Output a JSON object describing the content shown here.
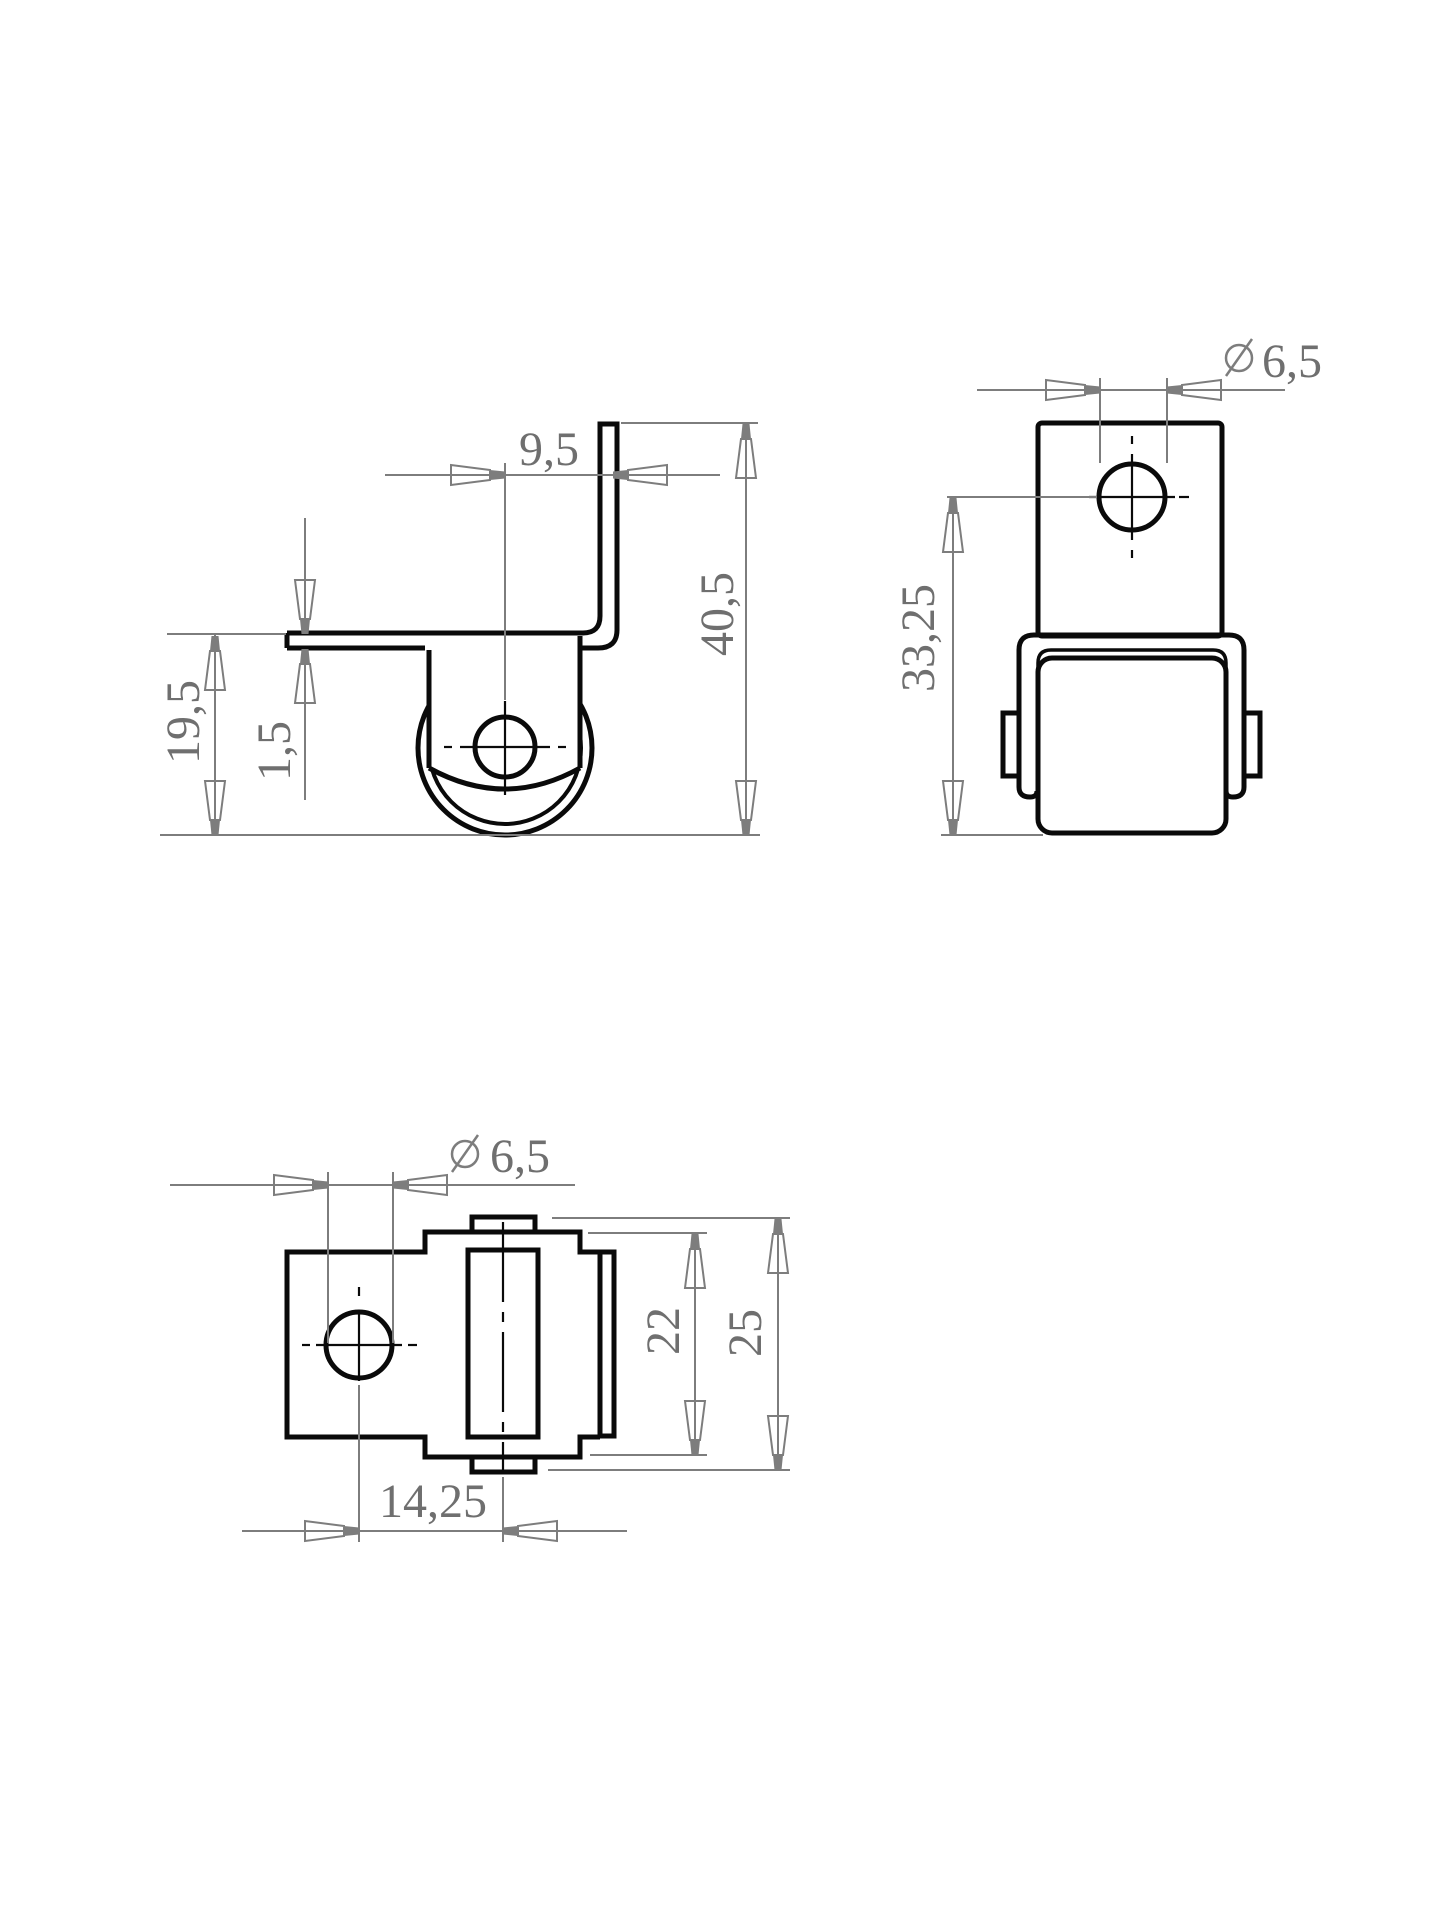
{
  "colors": {
    "outline": "#0a0a0a",
    "dimension": "#7d7d7d",
    "text": "#6f6f6f",
    "background": "#ffffff"
  },
  "diameter_symbol": "⌀",
  "dimensions": {
    "side_view": {
      "flange_offset": "9,5",
      "overall_height": "40,5",
      "bracket_height": "19,5",
      "plate_thickness": "1,5"
    },
    "front_view": {
      "hole_diameter": "6,5",
      "axle_height": "33,25"
    },
    "top_view": {
      "hole_diameter": "6,5",
      "hole_to_roller": "14,25",
      "fork_width": "22",
      "overall_width": "25"
    }
  }
}
